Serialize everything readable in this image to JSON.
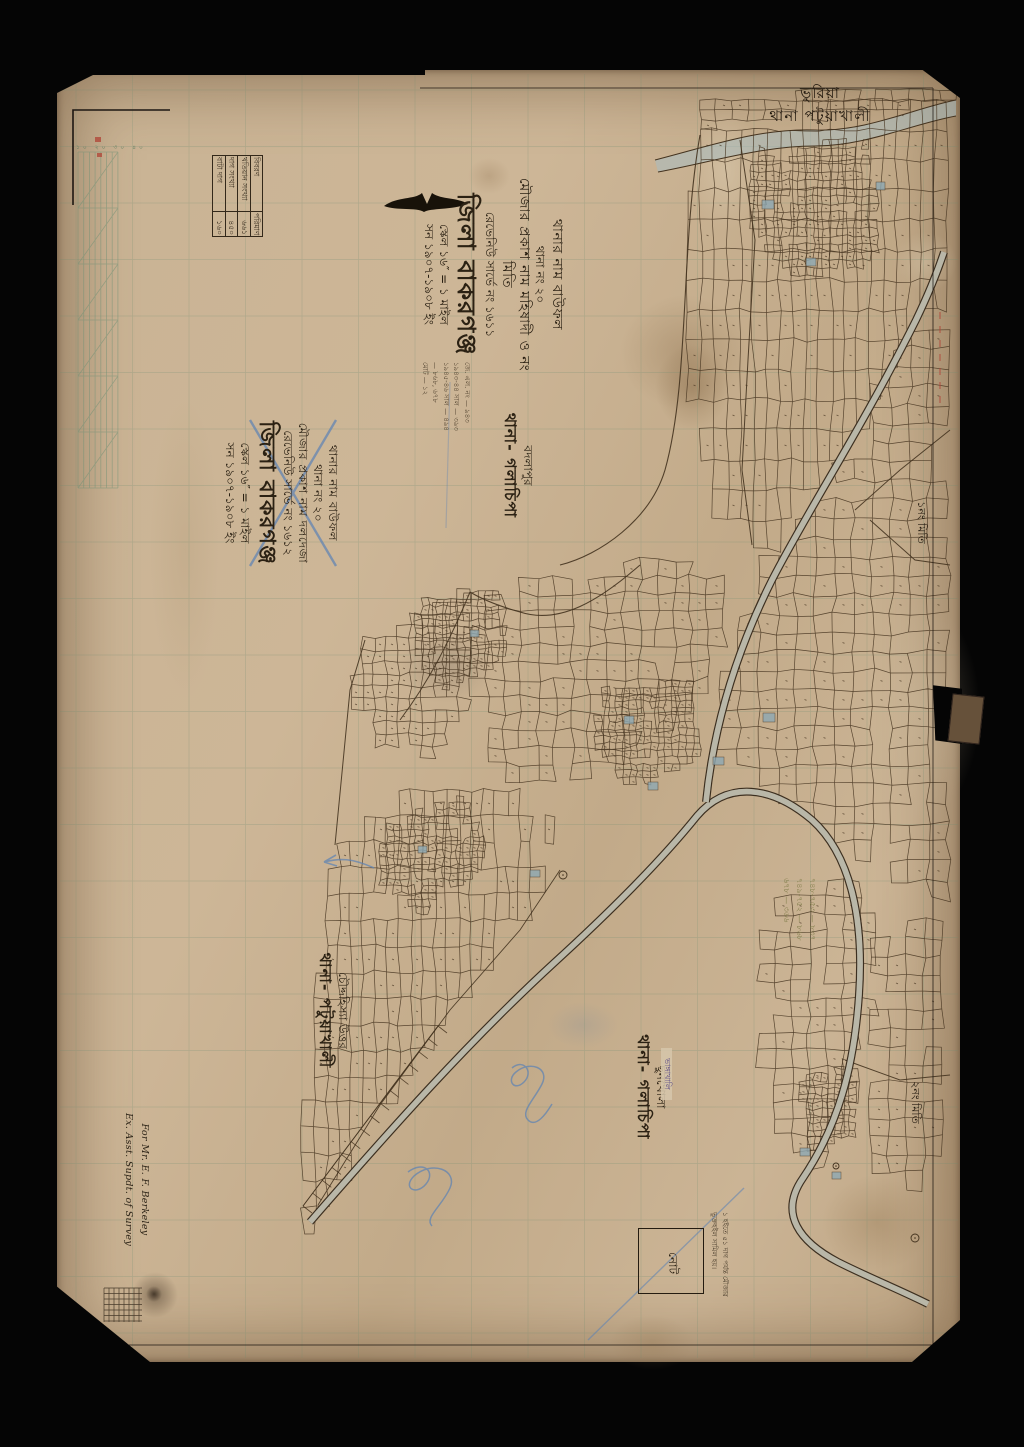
{
  "corner_header": {
    "line1": "ভুরিয়া",
    "line2": "থানা পটুয়াখালী"
  },
  "title_block_main": {
    "lines": [
      "থানার নাম বাউফল",
      "থানা নং ২০",
      "মৌজার প্রকাশ নাম মহিষাদী ও নং মিতি",
      "রেভেনিউ সার্ভে নং ১৬১১",
      "জিলা বাকরগঞ্জ",
      "স্কেল ১৬″ = ১ মাইল",
      "সন ১৯০৭-১৯০৮ ইং"
    ]
  },
  "title_block_crossed": {
    "lines": [
      "থানার নাম বাউফল",
      "থানা নং ২০",
      "মৌজার প্রকাশ নাম দলদেজা",
      "রেভেনিউ সার্ভে নং ১৬১২",
      "জিলা বাকরগঞ্জ",
      "স্কেল ১৬″ = ১ মাইল",
      "সন ১৯০৭-১৯০৮ ইং"
    ]
  },
  "legend_table": {
    "headers": [
      "বিবরণ",
      "পরিমাণ"
    ],
    "rows": [
      {
        "label": "খতিয়ান সংখ্যা",
        "value": "৬৬১"
      },
      {
        "label": "দাগ সংখ্যা",
        "value": "৪৫০"
      },
      {
        "label": "বাটা দাগ",
        "value": "১৬০"
      }
    ]
  },
  "small_notes": {
    "lines": [
      "জে. এল. নং — ৯৪৩",
      "১৯৪৩-৪৪ সাল — ৩৯৩",
      "১৯৪৫-৪৬ সাল — ৪৯৪",
      "— ৮৬৮, ৬৭৮",
      "মোট — ১২"
    ]
  },
  "labels": {
    "badlapur": {
      "place": "বদলাপুর",
      "thana": "থানা- গলাচিপা"
    },
    "chauddahissa": {
      "place": "চৌদ্দহিস্যা উত্তর",
      "thana": "থানা- পটুয়াখালী"
    },
    "chhunkhola": {
      "place": "ছুনখোলা",
      "thana": "থানা- গলাচিপা"
    },
    "miti1": "১নং মিতি",
    "miti2": "২নং মিতি",
    "stamp": "ভাঙ্গাখালি"
  },
  "note_box": {
    "box_label": "নোট",
    "lines": [
      "১ হইতে ৫১ দাগ পর্যন্ত মৌজার",
      "ভুক্তহইল সামিল হয়।"
    ]
  },
  "dedication": {
    "line1": "For Mr. E. F. Berkeley",
    "line2": "Ex. Asst. Supdt. of Survey"
  },
  "pencil_numbers": {
    "lines": [
      "৭৪৮-৭৫৩ — ৮৩৭",
      "৭৪৯-৭৫২ — ৮৬৮",
      "৬৭৮ — ৩৬৬"
    ]
  },
  "scale_bar_text": "১০ ২০ ৩০ ৪০",
  "colors": {
    "paper": "#c9b394",
    "ink": "#2b2113",
    "grid_green": "#6f8f74",
    "water": "#a8bec3",
    "pencil_blue": "#5b82b5",
    "pencil_olive": "#7c7a45"
  }
}
